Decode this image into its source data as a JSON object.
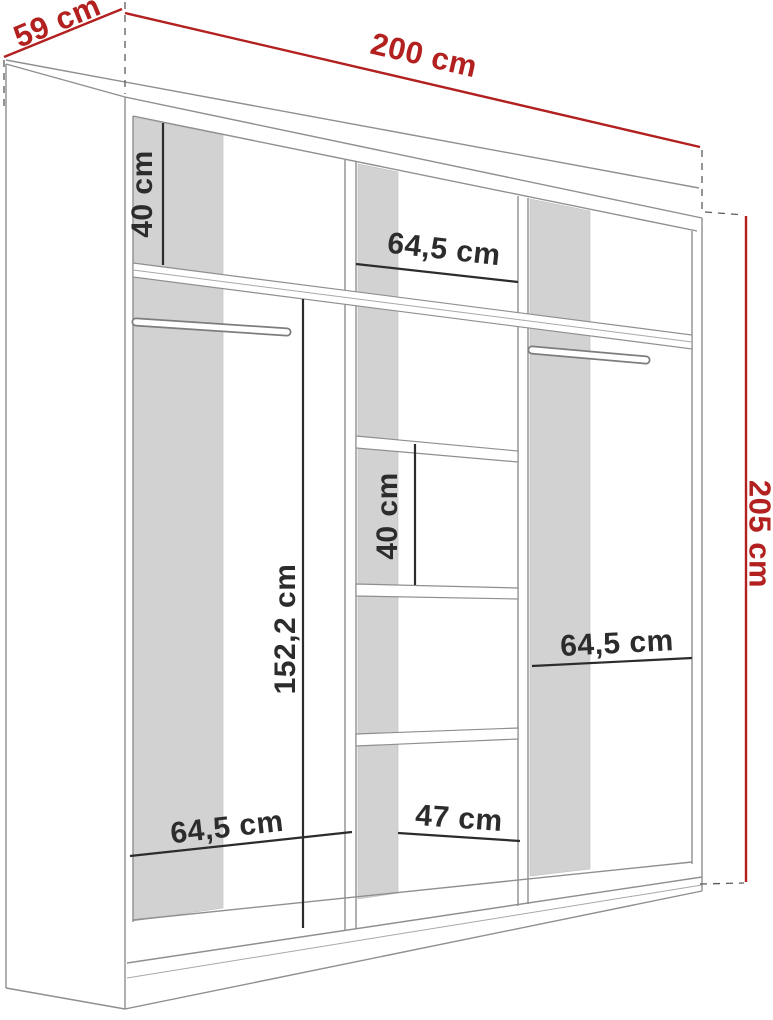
{
  "title": "Wardrobe interior dimension drawing",
  "units": "cm",
  "overall_dimensions": {
    "depth_label": "59 cm",
    "width_label": "200 cm",
    "height_label": "205 cm"
  },
  "interior_dimensions": {
    "left_top_shelf_height": "40 cm",
    "middle_top_section_width": "64,5 cm",
    "middle_shelf_spacing": "40 cm",
    "left_hanging_space_height": "152,2 cm",
    "right_section_width": "64,5 cm",
    "left_section_width": "64,5 cm",
    "middle_bottom_section_width": "47 cm"
  },
  "colors": {
    "dimension_accent_red": "#b2201f",
    "interior_dimension_black": "#2c2c2c",
    "panel_shade_gray": "#d2d2d2",
    "outline_gray": "#8f8f8f",
    "background": "#ffffff"
  }
}
